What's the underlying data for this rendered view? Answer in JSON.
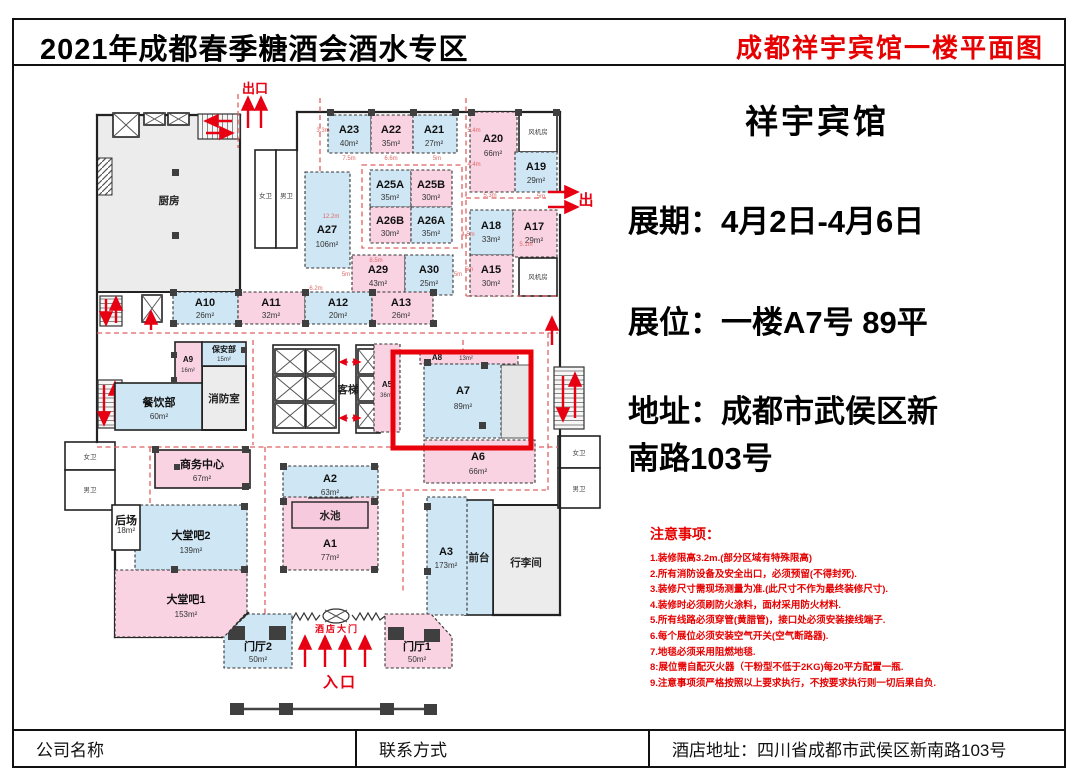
{
  "header": {
    "left_title": "2021年成都春季糖酒会酒水专区",
    "right_title": "成都祥宇宾馆一楼平面图"
  },
  "info": {
    "hotel_name": "祥宇宾馆",
    "line_period": "展期：4月2日-4月6日",
    "line_booth": "展位：一楼A7号 89平",
    "addr1": "地址：成都市武侯区新",
    "addr2": "南路103号"
  },
  "notes": {
    "title": "注意事项：",
    "items": [
      "1.装修限高3.2m.(部分区域有特殊限高)",
      "2.所有消防设备及安全出口，必须预留(不得封死).",
      "3.装修尺寸需现场测量为准.(此尺寸不作为最终装修尺寸).",
      "4.装修时必须刷防火涂料，面材采用防火材料.",
      "5.所有线路必须穿管(黄腊管)，接口处必须安装接线端子.",
      "6.每个展位必须安装空气开关(空气断路器).",
      "7.地毯必须采用阻燃地毯.",
      "8:展位需自配灭火器（干粉型不低于2KG)每20平方配置一瓶.",
      "9.注意事项须严格按照以上要求执行，不按要求执行则一切后果自负."
    ]
  },
  "footer": {
    "company": "公司名称",
    "contact": "联系方式",
    "address": "酒店地址：四川省成都市武侯区新南路103号"
  },
  "plan": {
    "booths": [
      {
        "id": "A23",
        "area": "40m²"
      },
      {
        "id": "A22",
        "area": "35m²"
      },
      {
        "id": "A21",
        "area": "27m²"
      },
      {
        "id": "A20",
        "area": "66m²"
      },
      {
        "id": "A19",
        "area": "29m²"
      },
      {
        "id": "A27",
        "area": "106m²"
      },
      {
        "id": "A25A",
        "area": "35m²"
      },
      {
        "id": "A25B",
        "area": "30m²"
      },
      {
        "id": "A26B",
        "area": "30m²"
      },
      {
        "id": "A26A",
        "area": "35m²"
      },
      {
        "id": "A18",
        "area": "33m²"
      },
      {
        "id": "A17",
        "area": "29m²"
      },
      {
        "id": "A29",
        "area": "43m²"
      },
      {
        "id": "A30",
        "area": "25m²"
      },
      {
        "id": "A15",
        "area": "30m²"
      },
      {
        "id": "A10",
        "area": "26m²"
      },
      {
        "id": "A11",
        "area": "32m²"
      },
      {
        "id": "A12",
        "area": "20m²"
      },
      {
        "id": "A13",
        "area": "26m²"
      },
      {
        "id": "A9",
        "area": "16m²"
      },
      {
        "id": "A5",
        "area": "36m²"
      },
      {
        "id": "A8",
        "area": "13m²"
      },
      {
        "id": "A7",
        "area": "89m²"
      },
      {
        "id": "A6",
        "area": "66m²"
      },
      {
        "id": "A2",
        "area": "63m²"
      },
      {
        "id": "A1",
        "area": "77m²"
      },
      {
        "id": "A3",
        "area": "173m²"
      },
      {
        "id": "门厅2",
        "area": "50m²"
      },
      {
        "id": "门厅1",
        "area": "50m²"
      },
      {
        "id": "大堂吧2",
        "area": "139m²"
      },
      {
        "id": "大堂吧1",
        "area": "153m²"
      },
      {
        "id": "商务中心",
        "area": "67m²"
      },
      {
        "id": "保安部",
        "area": "15m²"
      },
      {
        "id": "餐饮部",
        "area": "60m²"
      },
      {
        "id": "后场",
        "area": "18m²"
      }
    ],
    "rooms": {
      "kitchen": "厨房",
      "fire": "消防室",
      "luggage": "行李间",
      "front_desk": "前台",
      "pool": "水池",
      "elevator": "客梯",
      "fan": "风机房",
      "wc_f": "女卫",
      "wc_m": "男卫"
    },
    "labels": {
      "exit_top": "出口",
      "exit_right": "出",
      "gate": "酒店大门",
      "entrance": "入口"
    },
    "dimensions": [
      "7.5m",
      "6.6m",
      "5m",
      "12.2m",
      "6.2m",
      "8.5m",
      "5m",
      "5.4m",
      "4.4m",
      "5.3m",
      "5m",
      "4.5m",
      "5.1m",
      "5m",
      "3.3m",
      "5m"
    ]
  },
  "colors": {
    "booth_blue": "#cfe7f5",
    "booth_pink": "#f9d3e2",
    "room_gray": "#ececec",
    "note_red": "#e60000",
    "arrow_red": "#e60012",
    "dash_red": "#e06060",
    "highlight_red": "#e8000b"
  }
}
